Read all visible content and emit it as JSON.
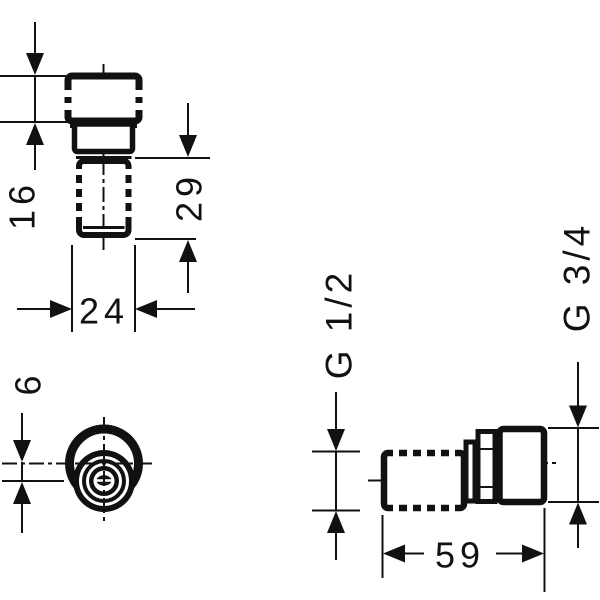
{
  "colors": {
    "ink": "#111111",
    "paper": "#ffffff"
  },
  "drawing": {
    "kind": "technical dimension drawing (eccentric pipe union, 3 views)",
    "views": {
      "front": {
        "dims": {
          "cap_height": "16",
          "thread_length": "29",
          "width": "24"
        }
      },
      "top": {
        "dims": {
          "eccentricity": "6"
        }
      },
      "side": {
        "dims": {
          "inlet_thread": "G 1/2",
          "outlet_thread": "G 3/4",
          "length": "59"
        }
      }
    }
  }
}
